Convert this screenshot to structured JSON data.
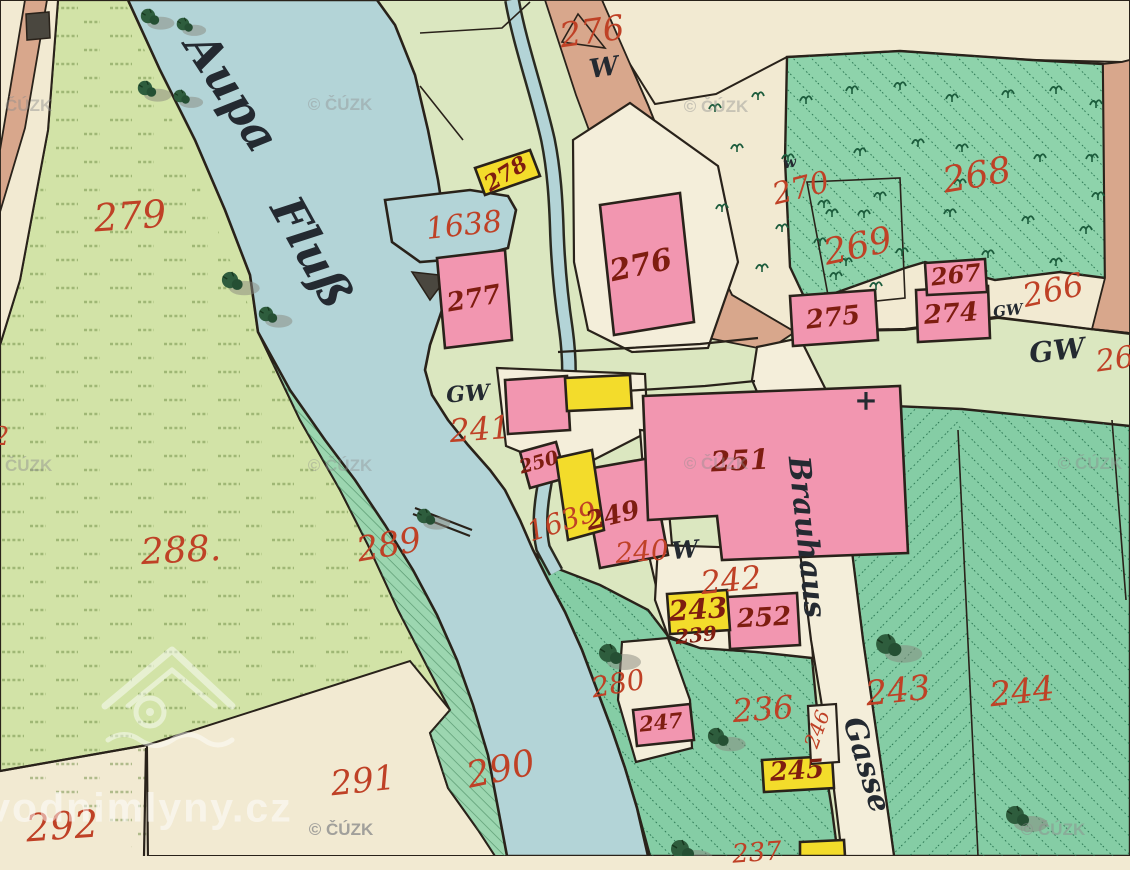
{
  "palette": {
    "water": "#b3d4d7",
    "outline": "#29221a",
    "cream": "#f2ead2",
    "creamroad": "#f4eeda",
    "fieldLeft": "#d2e3a7",
    "fieldCenter": "#dbe7c0",
    "tanRoad": "#d8a78c",
    "forest": "#8ed3ab",
    "meadow2": "#85cda5",
    "bank": "#9cd6b0",
    "pink": "#f296b0",
    "yellow": "#f3dc2b",
    "darkStruct": "#4a473f",
    "red": "#bf4126",
    "maroon": "#7e1d10",
    "ink": "#242a31",
    "wmgray": "#8e8e8e"
  },
  "map": {
    "river_name": "Aupa Fluß",
    "street_name": "Brauhaus Gasse",
    "watermarks": {
      "cuzk": "© ČÚZK",
      "site": "vodnimlyny.cz",
      "cuzk_positions": [
        {
          "x": 20,
          "y": 106,
          "o": 0.45
        },
        {
          "x": 340,
          "y": 105,
          "o": 0.4
        },
        {
          "x": 716,
          "y": 107,
          "o": 0.42
        },
        {
          "x": 20,
          "y": 466,
          "o": 0.45
        },
        {
          "x": 340,
          "y": 466,
          "o": 0.38
        },
        {
          "x": 716,
          "y": 464,
          "o": 0.4
        },
        {
          "x": 1090,
          "y": 464,
          "o": 0.42
        },
        {
          "x": 341,
          "y": 830,
          "o": 0.8
        },
        {
          "x": 1053,
          "y": 830,
          "o": 0.5
        }
      ],
      "site_pos": {
        "x": 140,
        "y": 808
      }
    },
    "labels": [
      {
        "n": "parcel-279",
        "t": "279",
        "x": 130,
        "y": 216,
        "s": 38,
        "r": -4,
        "c": "land"
      },
      {
        "n": "parcel-288",
        "t": "288.",
        "x": 181,
        "y": 551,
        "s": 36,
        "r": -3,
        "c": "land"
      },
      {
        "n": "parcel-289",
        "t": "289",
        "x": 389,
        "y": 545,
        "s": 34,
        "r": -10,
        "c": "land"
      },
      {
        "n": "parcel-290",
        "t": "290",
        "x": 501,
        "y": 770,
        "s": 36,
        "r": -12,
        "c": "land"
      },
      {
        "n": "parcel-291",
        "t": "291",
        "x": 363,
        "y": 781,
        "s": 34,
        "r": -6,
        "c": "land"
      },
      {
        "n": "parcel-292",
        "t": "292",
        "x": 62,
        "y": 826,
        "s": 38,
        "r": -4,
        "c": "land"
      },
      {
        "n": "parcel-276-top",
        "t": "276",
        "x": 592,
        "y": 32,
        "s": 34,
        "r": -8,
        "c": "land"
      },
      {
        "n": "parcel-270",
        "t": "270",
        "x": 801,
        "y": 189,
        "s": 30,
        "r": -14,
        "c": "land"
      },
      {
        "n": "parcel-268",
        "t": "268",
        "x": 977,
        "y": 176,
        "s": 36,
        "r": -10,
        "c": "land"
      },
      {
        "n": "parcel-269",
        "t": "269",
        "x": 858,
        "y": 247,
        "s": 36,
        "r": -12,
        "c": "land"
      },
      {
        "n": "parcel-266",
        "t": "266",
        "x": 1053,
        "y": 290,
        "s": 32,
        "r": -12,
        "c": "land"
      },
      {
        "n": "parcel-1638",
        "t": "1638",
        "x": 464,
        "y": 226,
        "s": 30,
        "r": -6,
        "c": "land"
      },
      {
        "n": "parcel-241",
        "t": "241",
        "x": 480,
        "y": 429,
        "s": 32,
        "r": -4,
        "c": "land"
      },
      {
        "n": "parcel-1639",
        "t": "1639",
        "x": 562,
        "y": 522,
        "s": 28,
        "r": -18,
        "c": "land"
      },
      {
        "n": "parcel-240",
        "t": "240",
        "x": 642,
        "y": 552,
        "s": 28,
        "r": -4,
        "c": "land"
      },
      {
        "n": "parcel-242",
        "t": "242",
        "x": 731,
        "y": 580,
        "s": 32,
        "r": -6,
        "c": "land"
      },
      {
        "n": "parcel-280",
        "t": "280",
        "x": 618,
        "y": 684,
        "s": 28,
        "r": -10,
        "c": "land"
      },
      {
        "n": "parcel-236",
        "t": "236",
        "x": 763,
        "y": 709,
        "s": 32,
        "r": -4,
        "c": "land"
      },
      {
        "n": "parcel-246",
        "t": "246",
        "x": 817,
        "y": 729,
        "s": 20,
        "r": -70,
        "c": "land"
      },
      {
        "n": "parcel-243-meadow",
        "t": "243",
        "x": 898,
        "y": 691,
        "s": 34,
        "r": -6,
        "c": "land"
      },
      {
        "n": "parcel-244",
        "t": "244",
        "x": 1022,
        "y": 692,
        "s": 34,
        "r": -6,
        "c": "land"
      },
      {
        "n": "parcel-237-clipped",
        "t": "237",
        "x": 757,
        "y": 853,
        "s": 26,
        "r": -4,
        "c": "land"
      },
      {
        "n": "parcel-2-clipped-left",
        "t": "2",
        "x": 1,
        "y": 437,
        "s": 26,
        "r": 0,
        "c": "land"
      },
      {
        "n": "parcel-26-clipped-right",
        "t": "26",
        "x": 1115,
        "y": 360,
        "s": 30,
        "r": -8,
        "c": "land"
      },
      {
        "n": "building-277",
        "t": "277",
        "x": 474,
        "y": 299,
        "s": 26,
        "r": -10,
        "c": "bldg"
      },
      {
        "n": "building-276",
        "t": "276",
        "x": 641,
        "y": 266,
        "s": 30,
        "r": -12,
        "c": "bldg"
      },
      {
        "n": "building-275",
        "t": "275",
        "x": 833,
        "y": 318,
        "s": 26,
        "r": -6,
        "c": "bldg"
      },
      {
        "n": "building-274",
        "t": "274",
        "x": 951,
        "y": 314,
        "s": 26,
        "r": -4,
        "c": "bldg"
      },
      {
        "n": "building-267",
        "t": "267",
        "x": 956,
        "y": 275,
        "s": 24,
        "r": -6,
        "c": "bldg"
      },
      {
        "n": "building-278",
        "t": "278",
        "x": 506,
        "y": 174,
        "s": 22,
        "r": -32,
        "c": "bldg"
      },
      {
        "n": "building-250",
        "t": "250",
        "x": 539,
        "y": 463,
        "s": 19,
        "r": -16,
        "c": "bldg"
      },
      {
        "n": "building-249",
        "t": "249",
        "x": 613,
        "y": 516,
        "s": 26,
        "r": -14,
        "c": "bldg"
      },
      {
        "n": "building-251",
        "t": "251",
        "x": 740,
        "y": 461,
        "s": 28,
        "r": -3,
        "c": "bldg"
      },
      {
        "n": "building-243",
        "t": "243",
        "x": 698,
        "y": 610,
        "s": 28,
        "r": -4,
        "c": "bldg"
      },
      {
        "n": "building-239",
        "t": "239",
        "x": 696,
        "y": 635,
        "s": 20,
        "r": -6,
        "c": "bldg"
      },
      {
        "n": "building-252",
        "t": "252",
        "x": 764,
        "y": 618,
        "s": 26,
        "r": -3,
        "c": "bldg"
      },
      {
        "n": "building-247",
        "t": "247",
        "x": 661,
        "y": 722,
        "s": 21,
        "r": -6,
        "c": "bldg"
      },
      {
        "n": "building-245",
        "t": "245",
        "x": 797,
        "y": 771,
        "s": 26,
        "r": -4,
        "c": "bldg"
      },
      {
        "n": "river-name-word1",
        "t": "Aupa",
        "x": 232,
        "y": 92,
        "s": 46,
        "r": 57,
        "c": "ink"
      },
      {
        "n": "river-name-word2",
        "t": "Fluß",
        "x": 312,
        "y": 252,
        "s": 46,
        "r": 61,
        "c": "ink"
      },
      {
        "n": "letter-w-1",
        "t": "W",
        "x": 604,
        "y": 68,
        "s": 26,
        "r": -8,
        "c": "ink"
      },
      {
        "n": "letter-w-2",
        "t": "w",
        "x": 790,
        "y": 163,
        "s": 15,
        "r": -10,
        "c": "ink"
      },
      {
        "n": "letter-w-240",
        "t": "W",
        "x": 685,
        "y": 550,
        "s": 24,
        "r": -5,
        "c": "ink"
      },
      {
        "n": "gw-label-1",
        "t": "GW",
        "x": 468,
        "y": 394,
        "s": 22,
        "r": -4,
        "c": "ink"
      },
      {
        "n": "gw-label-2",
        "t": "GW",
        "x": 1008,
        "y": 311,
        "s": 15,
        "r": -6,
        "c": "ink"
      },
      {
        "n": "gw-label-3",
        "t": "GW",
        "x": 1057,
        "y": 351,
        "s": 28,
        "r": -6,
        "c": "ink"
      },
      {
        "n": "street-brauhaus",
        "t": "Brauhaus",
        "x": 806,
        "y": 537,
        "s": 30,
        "r": 84,
        "c": "ink"
      },
      {
        "n": "street-gasse",
        "t": "Gasse",
        "x": 866,
        "y": 765,
        "s": 30,
        "r": 73,
        "c": "ink"
      },
      {
        "n": "boundary-cross",
        "t": "+",
        "x": 866,
        "y": 401,
        "s": 28,
        "r": 0,
        "c": "ink"
      }
    ],
    "forest_trees": [
      [
        715,
        108
      ],
      [
        758,
        96
      ],
      [
        806,
        100
      ],
      [
        852,
        90
      ],
      [
        900,
        86
      ],
      [
        952,
        98
      ],
      [
        1008,
        94
      ],
      [
        1056,
        90
      ],
      [
        1096,
        104
      ],
      [
        737,
        148
      ],
      [
        788,
        158
      ],
      [
        860,
        152
      ],
      [
        918,
        143
      ],
      [
        962,
        148
      ],
      [
        1040,
        158
      ],
      [
        1092,
        158
      ],
      [
        722,
        208
      ],
      [
        782,
        228
      ],
      [
        832,
        213
      ],
      [
        950,
        213
      ],
      [
        1028,
        220
      ],
      [
        1086,
        230
      ],
      [
        902,
        252
      ],
      [
        988,
        254
      ],
      [
        1056,
        262
      ],
      [
        836,
        276
      ],
      [
        762,
        268
      ],
      [
        1098,
        196
      ],
      [
        960,
        183
      ],
      [
        880,
        196
      ],
      [
        824,
        204
      ],
      [
        864,
        214
      ],
      [
        846,
        262
      ],
      [
        876,
        286
      ],
      [
        820,
        242
      ]
    ],
    "trees": [
      {
        "x": 148,
        "y": 16,
        "s": 0.8
      },
      {
        "x": 183,
        "y": 24,
        "s": 0.7
      },
      {
        "x": 145,
        "y": 88,
        "s": 0.8
      },
      {
        "x": 180,
        "y": 96,
        "s": 0.7
      },
      {
        "x": 230,
        "y": 280,
        "s": 0.9
      },
      {
        "x": 266,
        "y": 314,
        "s": 0.8
      },
      {
        "x": 424,
        "y": 516,
        "s": 0.8
      },
      {
        "x": 608,
        "y": 653,
        "s": 1
      },
      {
        "x": 716,
        "y": 736,
        "s": 0.9
      },
      {
        "x": 886,
        "y": 644,
        "s": 1.1
      },
      {
        "x": 1015,
        "y": 815,
        "s": 1
      },
      {
        "x": 680,
        "y": 849,
        "s": 1
      }
    ]
  }
}
